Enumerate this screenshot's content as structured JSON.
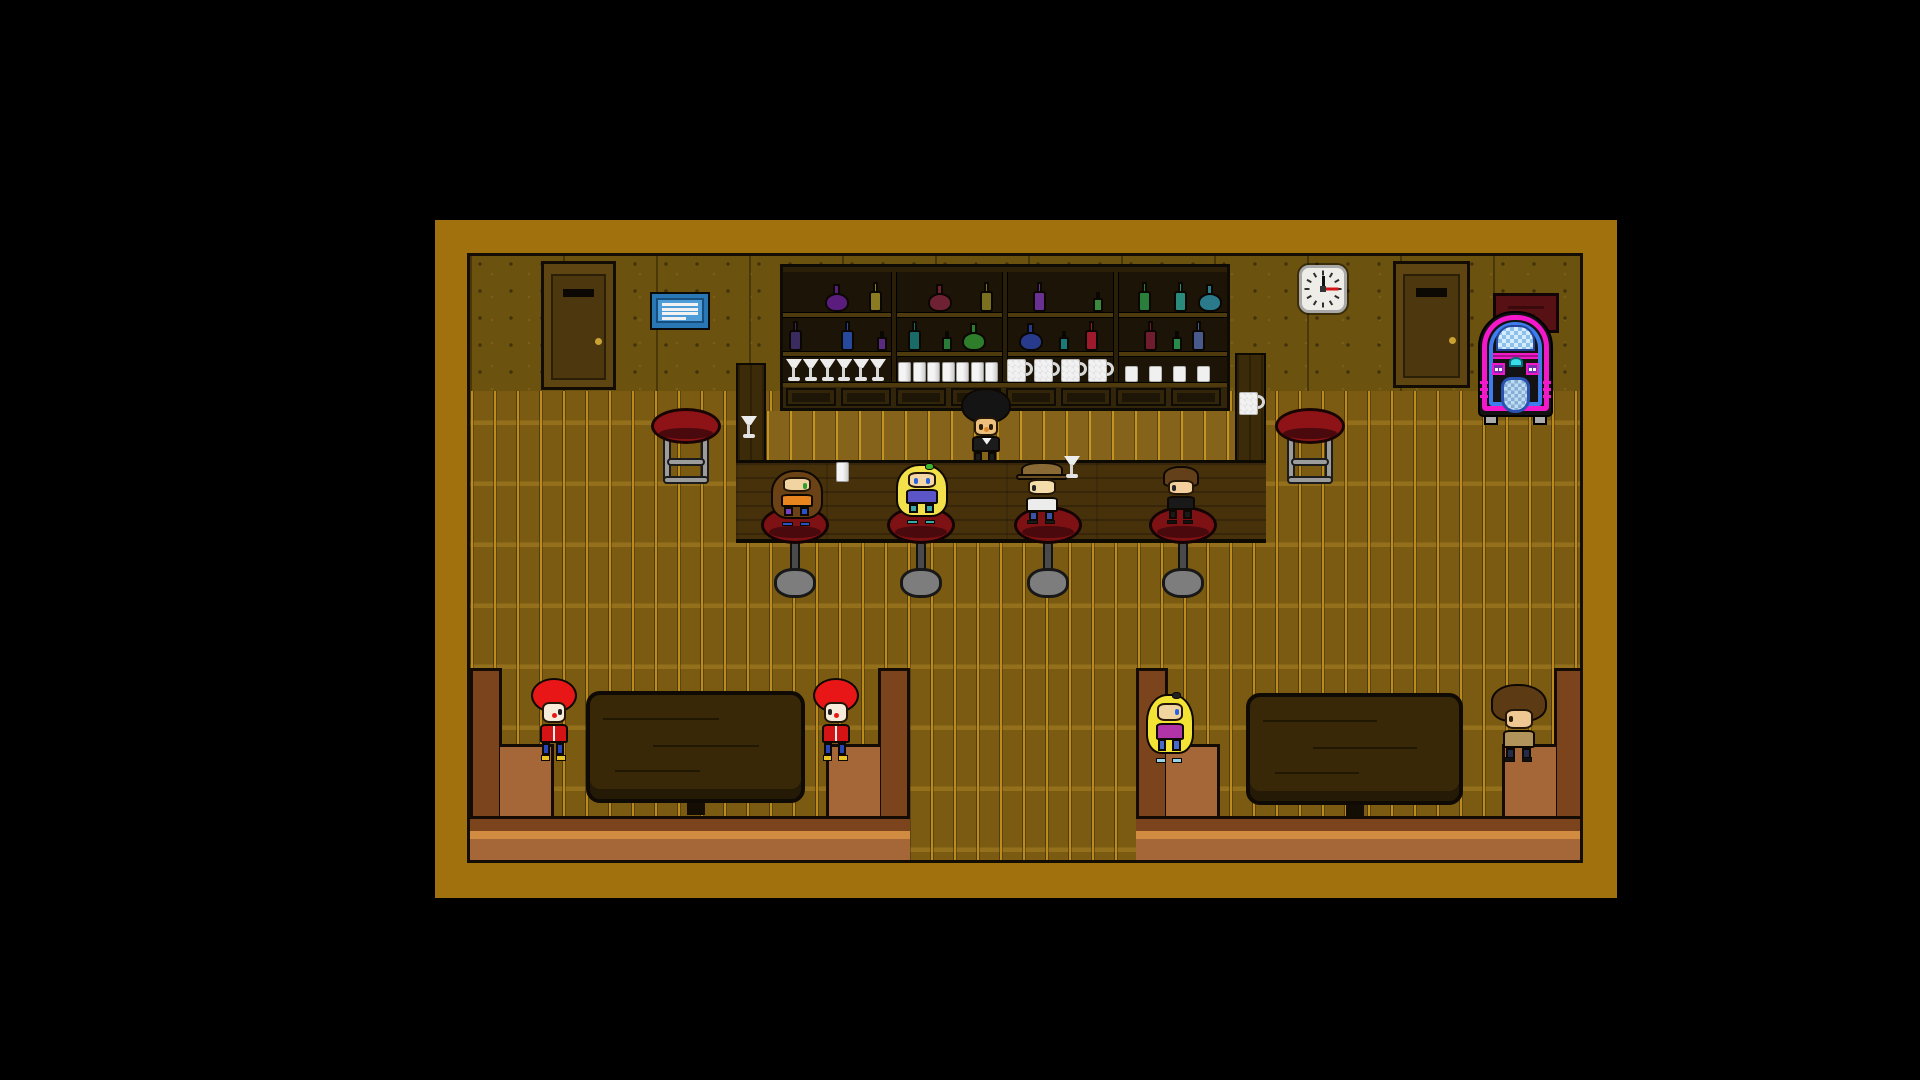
{
  "meta": {
    "title": "Pixel Tavern — Bar Interior Scene",
    "genre": "top-down pixel RPG"
  },
  "scene": {
    "canvas": {
      "w": 1920,
      "h": 1080,
      "bg": "#000000"
    },
    "frame": {
      "name": "game-viewport",
      "x": 435,
      "y": 220,
      "w": 1182,
      "h": 678,
      "border_color": "#a1710e",
      "inner": {
        "x": 32,
        "y": 33,
        "w": 1116,
        "h": 610
      }
    },
    "wall": {
      "h": 135,
      "color": "#6b520f"
    },
    "floor": {
      "color": "#7b5b12"
    },
    "door_colors": {
      "frame": "#5e4511",
      "panel": "#4c370e",
      "slot": "#0c0803",
      "knob": "#caa232"
    },
    "doors": [
      {
        "name": "door-left",
        "x": 71,
        "y": 5,
        "w": 75,
        "h": 129
      },
      {
        "name": "door-right",
        "x": 923,
        "y": 5,
        "w": 77,
        "h": 127
      }
    ],
    "sign": {
      "name": "menu-board",
      "x": 180,
      "y": 36,
      "w": 60,
      "h": 38,
      "frame": "#2a77b5",
      "panel": "#4f9dd8",
      "line_color": "#f2f2f2",
      "lines": 4
    },
    "clock": {
      "name": "wall-clock",
      "x": 829,
      "y": 9,
      "w": 48,
      "h": 48,
      "face": "#efede8",
      "border": "#a9a9a9",
      "tick": "#2e2e2e",
      "hour_hand": "#111111",
      "minute_hand": "#d41414",
      "hour_angle": 0,
      "minute_angle": 90
    },
    "poster": {
      "name": "wall-poster",
      "x": 1023,
      "y": 37,
      "w": 66,
      "h": 40,
      "color": "#571013",
      "line": "#39090b"
    },
    "jukebox": {
      "name": "jukebox",
      "x": 1008,
      "y": 47,
      "w": 75,
      "h": 122,
      "body": "#131313",
      "arch_outer": "#f318c9",
      "arch_inner": "#3f7cf0",
      "screen_a": "#d4ecff",
      "screen_b": "#8fc0ea",
      "dome": "#3adee6",
      "button_box": "#7a2db0",
      "button_dot": "#ffffff",
      "grille_a": "#bddcf4",
      "grille_b": "#86aed4",
      "feet": "#ababab"
    },
    "shelf": {
      "name": "back-bar-shelf",
      "x": 310,
      "y": 8,
      "w": 450,
      "h": 147,
      "frame": "#2c1f07",
      "interior": "#1d1408",
      "board": "#4e3a0c",
      "cabinet": "#33250a",
      "cabinet_panel": "#1d1506",
      "cabinet_doors": 8,
      "sections": [
        {
          "top": [
            {
              "shape": "round",
              "color": "#5a1d7d",
              "x": 42
            },
            {
              "shape": "tall",
              "color": "#8a7a22",
              "x": 86
            }
          ],
          "bottom": [
            {
              "shape": "tall",
              "color": "#3a2a5e",
              "x": 6
            },
            {
              "shape": "tall",
              "color": "#27499c",
              "x": 58
            },
            {
              "shape": "small",
              "color": "#5a2a80",
              "x": 94
            }
          ],
          "glasses": {
            "kind": "martini",
            "count": 6
          }
        },
        {
          "top": [
            {
              "shape": "round",
              "color": "#6e2133",
              "x": 34
            },
            {
              "shape": "tall",
              "color": "#7a7020",
              "x": 86
            }
          ],
          "bottom": [
            {
              "shape": "tall",
              "color": "#1a6a68",
              "x": 14
            },
            {
              "shape": "small",
              "color": "#2a7a3a",
              "x": 48
            },
            {
              "shape": "round",
              "color": "#2e7d2a",
              "x": 68
            }
          ],
          "glasses": {
            "kind": "tumbler",
            "count": 7
          }
        },
        {
          "top": [
            {
              "shape": "tall",
              "color": "#6a3193",
              "x": 28
            },
            {
              "shape": "small",
              "color": "#3a8a3e",
              "x": 88
            }
          ],
          "bottom": [
            {
              "shape": "round",
              "color": "#283a8c",
              "x": 14
            },
            {
              "shape": "small",
              "color": "#1a7a7a",
              "x": 54
            },
            {
              "shape": "tall",
              "color": "#9c1a2c",
              "x": 80
            }
          ],
          "glasses": {
            "kind": "mug",
            "count": 4
          }
        },
        {
          "top": [
            {
              "shape": "tall",
              "color": "#2a7e3c",
              "x": 22
            },
            {
              "shape": "tall",
              "color": "#2a8a7c",
              "x": 58
            },
            {
              "shape": "round",
              "color": "#2a7a8c",
              "x": 82
            }
          ],
          "bottom": [
            {
              "shape": "tall",
              "color": "#6e1c2e",
              "x": 28
            },
            {
              "shape": "small",
              "color": "#2a8a4a",
              "x": 56
            },
            {
              "shape": "tall",
              "color": "#49598c",
              "x": 76
            }
          ],
          "glasses": {
            "kind": "cup",
            "count": 4
          }
        }
      ]
    },
    "bar": {
      "wood_dark": "#3c2b09",
      "counter_color": "#46310b",
      "left_post": {
        "x": 266,
        "y": 107,
        "w": 30,
        "h": 180
      },
      "right_post": {
        "x": 765,
        "y": 97,
        "w": 31,
        "h": 190
      },
      "strip": {
        "x": 296,
        "y": 155,
        "w": 469,
        "h": 49,
        "color": "#85631a"
      },
      "counter": {
        "x": 266,
        "y": 204,
        "w": 530,
        "h": 83
      }
    },
    "counter_items": [
      {
        "kind": "martini",
        "x": 271,
        "y": 160
      },
      {
        "kind": "tumbler",
        "x": 366,
        "y": 206
      },
      {
        "kind": "martini",
        "x": 594,
        "y": 200
      },
      {
        "kind": "mug",
        "x": 769,
        "y": 135
      }
    ],
    "stool_colors": {
      "seat": "#7e1114",
      "rim": "#4a090c",
      "side_seat": "#8e1316",
      "leg": "#9c9c9c",
      "column": "#4a4a4a",
      "base": "#7d7d7d"
    },
    "wall_stools": [
      {
        "name": "side-stool-left",
        "x": 181,
        "y": 152
      },
      {
        "name": "side-stool-right",
        "x": 805,
        "y": 152
      }
    ],
    "bar_stools": {
      "y": 250,
      "centers": [
        325,
        451,
        578,
        713
      ]
    },
    "booth_colors": {
      "back": "#7c441c",
      "seat": "#a56737",
      "highlight": "#d28c42",
      "outline": "#140b04",
      "table": "#382808",
      "table_edge": "#241806"
    },
    "booths": [
      {
        "name": "booth-left",
        "x": 0,
        "y": 412,
        "w": 440,
        "h": 198,
        "table": {
          "x": 116,
          "y": 23,
          "w": 219,
          "h": 112
        }
      },
      {
        "name": "booth-right",
        "x": 666,
        "y": 412,
        "w": 450,
        "h": 198,
        "table": {
          "x": 110,
          "y": 25,
          "w": 217,
          "h": 112
        }
      }
    ],
    "characters": [
      {
        "name": "bartender",
        "x": 498,
        "y": 139,
        "w": 36,
        "h": 70,
        "z": 3,
        "hair": "afro-tall",
        "hair_color": "#141414",
        "face": "#eec07e",
        "eye": "#2a1c0a",
        "nose": "#e08a2a",
        "top": "#1c1c1c",
        "top_detail": "collar",
        "legs": "#1c1c1c",
        "legs2": "#1c1c1c",
        "shoes": "",
        "facing": "down",
        "role": "bartender"
      },
      {
        "name": "customer-brunette",
        "x": 306,
        "y": 212,
        "w": 42,
        "h": 58,
        "hair": "long",
        "hair_color": "#6b4116",
        "face": "#f2d3a2",
        "eye": "#2ba02b",
        "top": "#e8851e",
        "legs": "#7a3fc2",
        "legs2": "#2a52c8",
        "shoes": "#2a52c8",
        "facing": "right",
        "role": "customer-on-stool"
      },
      {
        "name": "customer-blonde",
        "x": 431,
        "y": 206,
        "w": 42,
        "h": 62,
        "hair": "long",
        "hair_color": "#f2e14a",
        "accessory": "#3bb42e",
        "face": "#f5d7a5",
        "eye": "#2a62e0",
        "top": "#5b55c8",
        "legs": "#3aa8a8",
        "legs2": "#3aa8a8",
        "shoes": "#3aa8a8",
        "facing": "down",
        "role": "customer-on-stool"
      },
      {
        "name": "customer-hat",
        "x": 551,
        "y": 206,
        "w": 42,
        "h": 62,
        "hair": "hat",
        "hair_color": "#8a6a34",
        "hat_band": "#6a4f22",
        "face": "#f5dcab",
        "eye": "#222222",
        "top": "#ececec",
        "legs": "#3a55a8",
        "legs2": "#3a55a8",
        "shoes": "#1a1a1a",
        "facing": "left",
        "role": "customer-on-stool"
      },
      {
        "name": "customer-dark",
        "x": 692,
        "y": 210,
        "w": 38,
        "h": 58,
        "hair": "short",
        "hair_color": "#63401a",
        "face": "#f2cf9c",
        "eye": "#222222",
        "top": "#191919",
        "legs": "#191919",
        "legs2": "#191919",
        "shoes": "#111111",
        "facing": "left",
        "role": "customer-on-stool"
      },
      {
        "name": "booth-kid-red-left",
        "x": 66,
        "y": 425,
        "w": 36,
        "h": 80,
        "hair": "afro",
        "hair_color": "#e81616",
        "face": "#f6ecd9",
        "eye": "#222222",
        "nose": "#e81616",
        "top": "#d41414",
        "top_detail": "zip",
        "legs": "#2746b8",
        "legs2": "#2746b8",
        "shoes": "#e8c322",
        "facing": "right",
        "role": "booth-guest"
      },
      {
        "name": "booth-kid-red-right",
        "x": 348,
        "y": 425,
        "w": 36,
        "h": 80,
        "hair": "afro",
        "hair_color": "#e81616",
        "face": "#f6ecd9",
        "eye": "#222222",
        "nose": "#e81616",
        "top": "#d41414",
        "top_detail": "zip",
        "legs": "#2746b8",
        "legs2": "#2746b8",
        "shoes": "#e8c322",
        "facing": "left",
        "role": "booth-guest"
      },
      {
        "name": "booth-blonde",
        "x": 681,
        "y": 435,
        "w": 38,
        "h": 72,
        "hair": "long",
        "hair_color": "#f2e334",
        "accessory": "#222222",
        "face": "#f2d4a0",
        "eye": "#2a62e0",
        "top": "#b033a8",
        "legs": "#4a6ac8",
        "legs2": "#4a6ac8",
        "shoes": "#9ad4e8",
        "facing": "right",
        "role": "booth-guest"
      },
      {
        "name": "booth-brown",
        "x": 1028,
        "y": 430,
        "w": 42,
        "h": 76,
        "hair": "messy",
        "hair_color": "#5c3a14",
        "face": "#eec793",
        "eye": "#2a1c0a",
        "top": "#b2935a",
        "legs": "#232c48",
        "legs2": "#232c48",
        "shoes": "#111111",
        "facing": "left",
        "role": "booth-guest"
      }
    ]
  }
}
